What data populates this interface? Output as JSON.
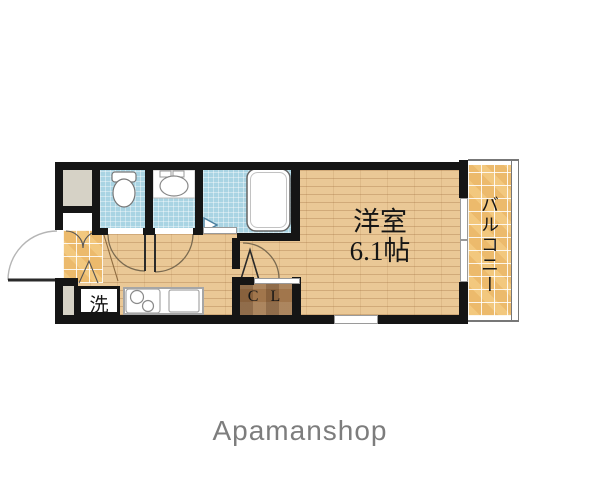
{
  "floorplan": {
    "room_label": {
      "name": "洋室",
      "size": "6.1帖"
    },
    "balcony_label": "バルコニー",
    "closet_label": "C L",
    "laundry_label": "洗",
    "brand": "Apamanshop",
    "colors": {
      "wall": "#151515",
      "wood_floor": "#eac896",
      "tile_floor": "#ecba6c",
      "wet_area_blue": "#a9d4e3",
      "closet_brown": "#a1764c",
      "alcove_gray": "#d6d2c6",
      "brand_text": "#7d7d7d"
    }
  }
}
